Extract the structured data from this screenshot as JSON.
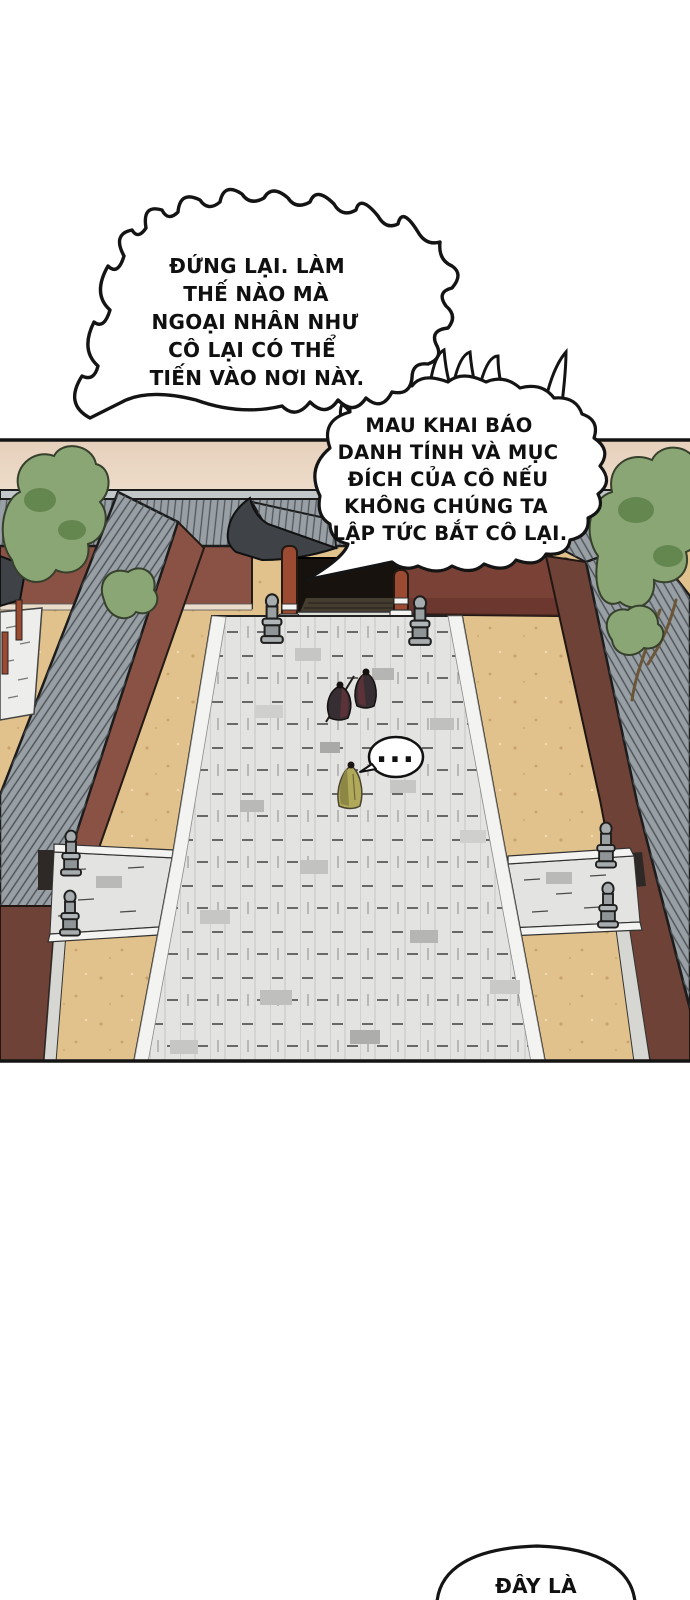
{
  "page": {
    "type": "comic-page",
    "language": "vi",
    "width": 690,
    "height": 1600
  },
  "palette": {
    "ink": "#141414",
    "bubble_fill": "#ffffff",
    "sky_top": "#e6d0bc",
    "sky_bottom": "#f7eedd",
    "sand": "#e2c28c",
    "path_stone": "#e3e3e1",
    "path_edge": "#f3f3f1",
    "roof_gray": "#98a0a5",
    "roof_ridge": "#c2c7ca",
    "roof_dark": "#3f4347",
    "wall_red": "#8a5244",
    "wall_red_dark": "#6e4237",
    "wall_bumpy": "#7a4237",
    "gate_red": "#9d4a33",
    "gate_opening": "#17120d",
    "tree_green": "#8ba675",
    "tree_green_dark": "#648750",
    "stone_light": "#d6d6d2",
    "figure_dark": "#372e33",
    "figure_maroon": "#5a3238",
    "cloak_yellow": "#b1a95a"
  },
  "bubbles": {
    "halt": {
      "style": "spiky-burst",
      "lines": [
        "ĐỨNG LẠI. LÀM",
        "THẾ NÀO MÀ",
        "NGOẠI NHÂN NHƯ",
        "CÔ LẠI CÓ THỂ",
        "TIẾN VÀO NƠI NÀY."
      ]
    },
    "demand": {
      "style": "burst-cloud",
      "lines": [
        "MAU KHAI BÁO",
        "DANH TÍNH VÀ MỤC",
        "ĐÍCH CỦA CÔ NẾU",
        "KHÔNG CHÚNG TA",
        "LẬP TỨC BẮT CÔ LẠI."
      ]
    },
    "silence": {
      "style": "small-oval",
      "text": "..."
    },
    "bottom_partial": {
      "style": "oval-cut-by-page-edge",
      "text": "ĐÂY LÀ"
    }
  },
  "scene": {
    "description": "aerial view of a walled compound: tiled-roof perimeter walls, gate at top, stone slab path through a sand courtyard, side walkways with stone posts, trees",
    "figures": [
      {
        "name": "guard-with-spear"
      },
      {
        "name": "guard"
      },
      {
        "name": "yellow-cloaked-visitor"
      }
    ]
  }
}
